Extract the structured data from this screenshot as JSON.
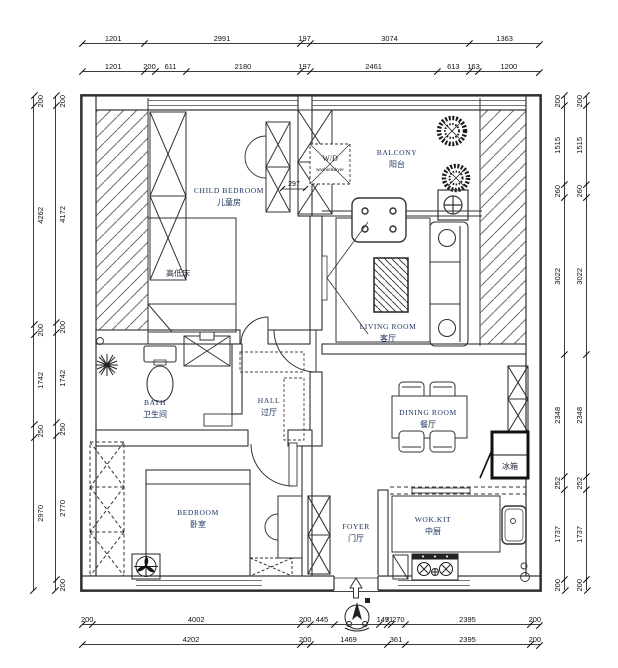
{
  "drawing_type": "apartment floor plan",
  "colors": {
    "wall_line": "#2f2f2f",
    "furniture_line": "#333333",
    "room_text": "#1d3263",
    "dim_text": "#111111",
    "background": "#ffffff"
  },
  "rooms": {
    "child_bedroom": {
      "en": "CHILD BEDROOM",
      "zh": "儿童房"
    },
    "bunk_bed": "高低床",
    "balcony": {
      "en": "BALCONY",
      "zh": "阳台"
    },
    "living_room": {
      "en": "LIVING ROOM",
      "zh": "客厅"
    },
    "bath": {
      "en": "BATH",
      "zh": "卫生间"
    },
    "hall": {
      "en": "HALL",
      "zh": "过厅"
    },
    "dining_room": {
      "en": "DINING ROOM",
      "zh": "餐厅"
    },
    "bedroom": {
      "en": "BEDROOM",
      "zh": "卧室"
    },
    "foyer": {
      "en": "FOYER",
      "zh": "门厅"
    },
    "wok_kitchen": {
      "en": "WOK.KIT",
      "zh": "中厨"
    },
    "fridge": "冰箱",
    "washer": {
      "label": "W/D",
      "sub": "washer&dryer"
    }
  },
  "inner_dimensions": {
    "cabinet_width": "297"
  },
  "dimensions": {
    "top_outer": [
      {
        "label": "1201",
        "mm": 1201
      },
      {
        "label": "2991",
        "mm": 2991
      },
      {
        "label": "197",
        "mm": 197
      },
      {
        "label": "3074",
        "mm": 3074
      },
      {
        "label": "1363",
        "mm": 1363
      }
    ],
    "top_inner": [
      {
        "label": "1201",
        "mm": 1201
      },
      {
        "label": "200",
        "mm": 200
      },
      {
        "label": "611",
        "mm": 611
      },
      {
        "label": "2180",
        "mm": 2180
      },
      {
        "label": "197",
        "mm": 197
      },
      {
        "label": "2461",
        "mm": 2461
      },
      {
        "label": "613",
        "mm": 613
      },
      {
        "label": "163",
        "mm": 163
      },
      {
        "label": "1200",
        "mm": 1200
      }
    ],
    "left_outer": [
      {
        "label": "200",
        "mm": 200
      },
      {
        "label": "4262",
        "mm": 4262
      },
      {
        "label": "200",
        "mm": 200
      },
      {
        "label": "1742",
        "mm": 1742
      },
      {
        "label": "250",
        "mm": 250
      },
      {
        "label": "2970",
        "mm": 2970
      }
    ],
    "left_inner": [
      {
        "label": "200",
        "mm": 200
      },
      {
        "label": "4172",
        "mm": 4172
      },
      {
        "label": "200",
        "mm": 200
      },
      {
        "label": "1742",
        "mm": 1742
      },
      {
        "label": "250",
        "mm": 250
      },
      {
        "label": "2770",
        "mm": 2770
      },
      {
        "label": "200",
        "mm": 200
      }
    ],
    "right_inner": [
      {
        "label": "200",
        "mm": 200
      },
      {
        "label": "1515",
        "mm": 1515
      },
      {
        "label": "260",
        "mm": 260
      },
      {
        "label": "3022",
        "mm": 3022
      },
      {
        "label": "2348",
        "mm": 2348
      },
      {
        "label": "252",
        "mm": 252
      },
      {
        "label": "1737",
        "mm": 1737
      },
      {
        "label": "200",
        "mm": 200
      }
    ],
    "right_outer": [
      {
        "label": "200",
        "mm": 200
      },
      {
        "label": "1515",
        "mm": 1515
      },
      {
        "label": "260",
        "mm": 260
      },
      {
        "label": "3022",
        "mm": 3022
      },
      {
        "label": "2348",
        "mm": 2348
      },
      {
        "label": "252",
        "mm": 252
      },
      {
        "label": "1737",
        "mm": 1737
      },
      {
        "label": "200",
        "mm": 200
      }
    ],
    "bottom_upper": [
      {
        "label": "200",
        "mm": 200
      },
      {
        "label": "4002",
        "mm": 4002
      },
      {
        "label": "200",
        "mm": 200
      },
      {
        "label": "445",
        "mm": 445
      },
      {
        "label": "",
        "mm": 877
      },
      {
        "label": "147",
        "mm": 147
      },
      {
        "label": "91",
        "mm": 91
      },
      {
        "label": "270",
        "mm": 270
      },
      {
        "label": "2395",
        "mm": 2395
      },
      {
        "label": "200",
        "mm": 200
      }
    ],
    "bottom_lower": [
      {
        "label": "4202",
        "mm": 4202
      },
      {
        "label": "200",
        "mm": 200
      },
      {
        "label": "1469",
        "mm": 1469
      },
      {
        "label": "361",
        "mm": 361
      },
      {
        "label": "2395",
        "mm": 2395
      },
      {
        "label": "200",
        "mm": 200
      }
    ]
  }
}
